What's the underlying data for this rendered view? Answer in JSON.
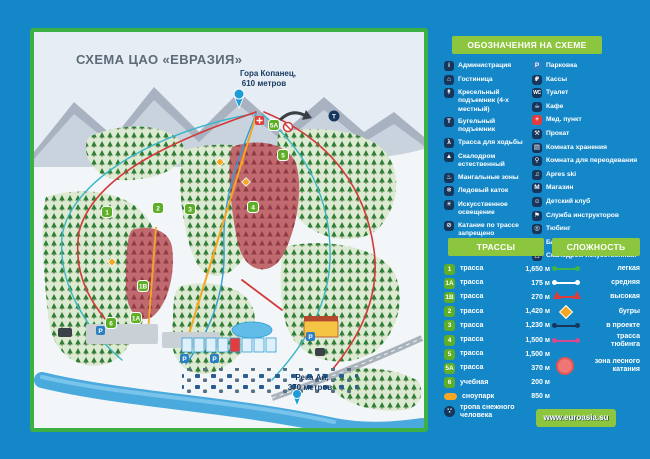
{
  "colors": {
    "background": "#1487c8",
    "accent_green": "#8cc63e",
    "map_border_green": "#3cb044",
    "icon_navy": "#17365c",
    "parking_blue": "#2b7fc3",
    "medical_red": "#e23c3c",
    "trail_badge_green": "#5fae27",
    "snowpark_orange": "#f5a623",
    "difficulty_easy": "#3cb54a",
    "difficulty_medium": "#ffffff",
    "difficulty_high": "#e03a3a",
    "moguls": "#f5a623",
    "planned": "#17365c",
    "tubing": "#d84a8e",
    "forest_zone_pink": "#f07575"
  },
  "map": {
    "title": "СХЕМА ЦАО «ЕВРАЗИЯ»",
    "peak_line1": "Гора Копанец,",
    "peak_line2": "610 метров",
    "river_line1": "Река Ай,",
    "river_line2": "370 метров",
    "badges": {
      "b1": "1",
      "b1a": "1А",
      "b1b": "1В",
      "b2": "2",
      "b3": "3",
      "b4": "4",
      "b5": "5",
      "b5a": "5А",
      "b6": "6"
    }
  },
  "legend": {
    "title": "ОБОЗНАЧЕНИЯ НА СХЕМЕ",
    "left": [
      {
        "label": "Администрация",
        "icon": "admin-icon",
        "glyph": "i"
      },
      {
        "label": "Гостиница",
        "icon": "hotel-icon",
        "glyph": "⌂"
      },
      {
        "label": "Кресельный подъемник (4-х местный)",
        "icon": "chairlift-icon",
        "glyph": "↟"
      },
      {
        "label": "Бугельный подъемник",
        "icon": "tbar-lift-icon",
        "glyph": "T"
      },
      {
        "label": "Трасса для ходьбы",
        "icon": "walking-trail-icon",
        "glyph": "λ"
      },
      {
        "label": "Скалодром естественный",
        "icon": "natural-climbing-wall-icon",
        "glyph": "▲"
      },
      {
        "label": "Мангальные зоны",
        "icon": "bbq-zone-icon",
        "glyph": "♨"
      },
      {
        "label": "Ледовый каток",
        "icon": "ice-rink-icon",
        "glyph": "❄"
      },
      {
        "label": "Искусственное освещение",
        "icon": "artificial-lighting-icon",
        "glyph": "☀"
      },
      {
        "label": "Катание по трассе запрещено",
        "icon": "no-skiing-icon",
        "glyph": "⊘"
      }
    ],
    "right": [
      {
        "label": "Парковка",
        "icon": "parking-icon",
        "glyph": "P"
      },
      {
        "label": "Кассы",
        "icon": "ticket-office-icon",
        "glyph": "₽"
      },
      {
        "label": "Туалет",
        "icon": "toilet-icon",
        "glyph": "WC"
      },
      {
        "label": "Кафе",
        "icon": "cafe-icon",
        "glyph": "☕"
      },
      {
        "label": "Мед. пункт",
        "icon": "medical-point-icon",
        "glyph": "+"
      },
      {
        "label": "Прокат",
        "icon": "rental-icon",
        "glyph": "⚒"
      },
      {
        "label": "Комната хранения",
        "icon": "storage-room-icon",
        "glyph": "▤"
      },
      {
        "label": "Комната для переодевания",
        "icon": "changing-room-icon",
        "glyph": "⚲"
      },
      {
        "label": "Apres ski",
        "icon": "apres-ski-icon",
        "glyph": "♫"
      },
      {
        "label": "Магазин",
        "icon": "shop-icon",
        "glyph": "М"
      },
      {
        "label": "Детский клуб",
        "icon": "kids-club-icon",
        "glyph": "☺"
      },
      {
        "label": "Служба инструкторов",
        "icon": "instructors-icon",
        "glyph": "⚑"
      },
      {
        "label": "Тюбинг",
        "icon": "tubing-icon",
        "glyph": "◎"
      },
      {
        "label": "Батут",
        "icon": "trampoline-icon",
        "glyph": "⇞"
      },
      {
        "label": "Скалодром искусственный",
        "icon": "artificial-climbing-wall-icon",
        "glyph": "△"
      }
    ]
  },
  "trails": {
    "title": "ТРАССЫ",
    "rows": [
      {
        "num": "1",
        "label": "трасса",
        "length": "1,650 м"
      },
      {
        "num": "1А",
        "label": "трасса",
        "length": "175 м"
      },
      {
        "num": "1В",
        "label": "трасса",
        "length": "270 м"
      },
      {
        "num": "2",
        "label": "трасса",
        "length": "1,420 м"
      },
      {
        "num": "3",
        "label": "трасса",
        "length": "1,230 м"
      },
      {
        "num": "4",
        "label": "трасса",
        "length": "1,500 м"
      },
      {
        "num": "5",
        "label": "трасса",
        "length": "1,500 м"
      },
      {
        "num": "5А",
        "label": "трасса",
        "length": "370 м"
      },
      {
        "num": "6",
        "label": "учебная",
        "length": "200 м"
      },
      {
        "num": "",
        "label": "сноупарк",
        "length": "850 м"
      },
      {
        "num": "∵",
        "label": "тропа снежного человека",
        "length": ""
      }
    ]
  },
  "difficulty": {
    "title": "СЛОЖНОСТЬ",
    "rows": [
      {
        "label": "легкая",
        "marker": "line",
        "color": "#3cb54a"
      },
      {
        "label": "средняя",
        "marker": "line",
        "color": "#ffffff"
      },
      {
        "label": "высокая",
        "marker": "triangle-line",
        "color": "#e03a3a"
      },
      {
        "label": "бугры",
        "marker": "diamond",
        "color": "#f5a623"
      },
      {
        "label": "в проекте",
        "marker": "line",
        "color": "#17365c"
      },
      {
        "label": "трасса тюбинга",
        "marker": "line",
        "color": "#d84a8e"
      }
    ],
    "zone": {
      "label": "зона лесного катания",
      "color": "#f07575"
    }
  },
  "footer": {
    "url": "www.euroasia.su"
  }
}
